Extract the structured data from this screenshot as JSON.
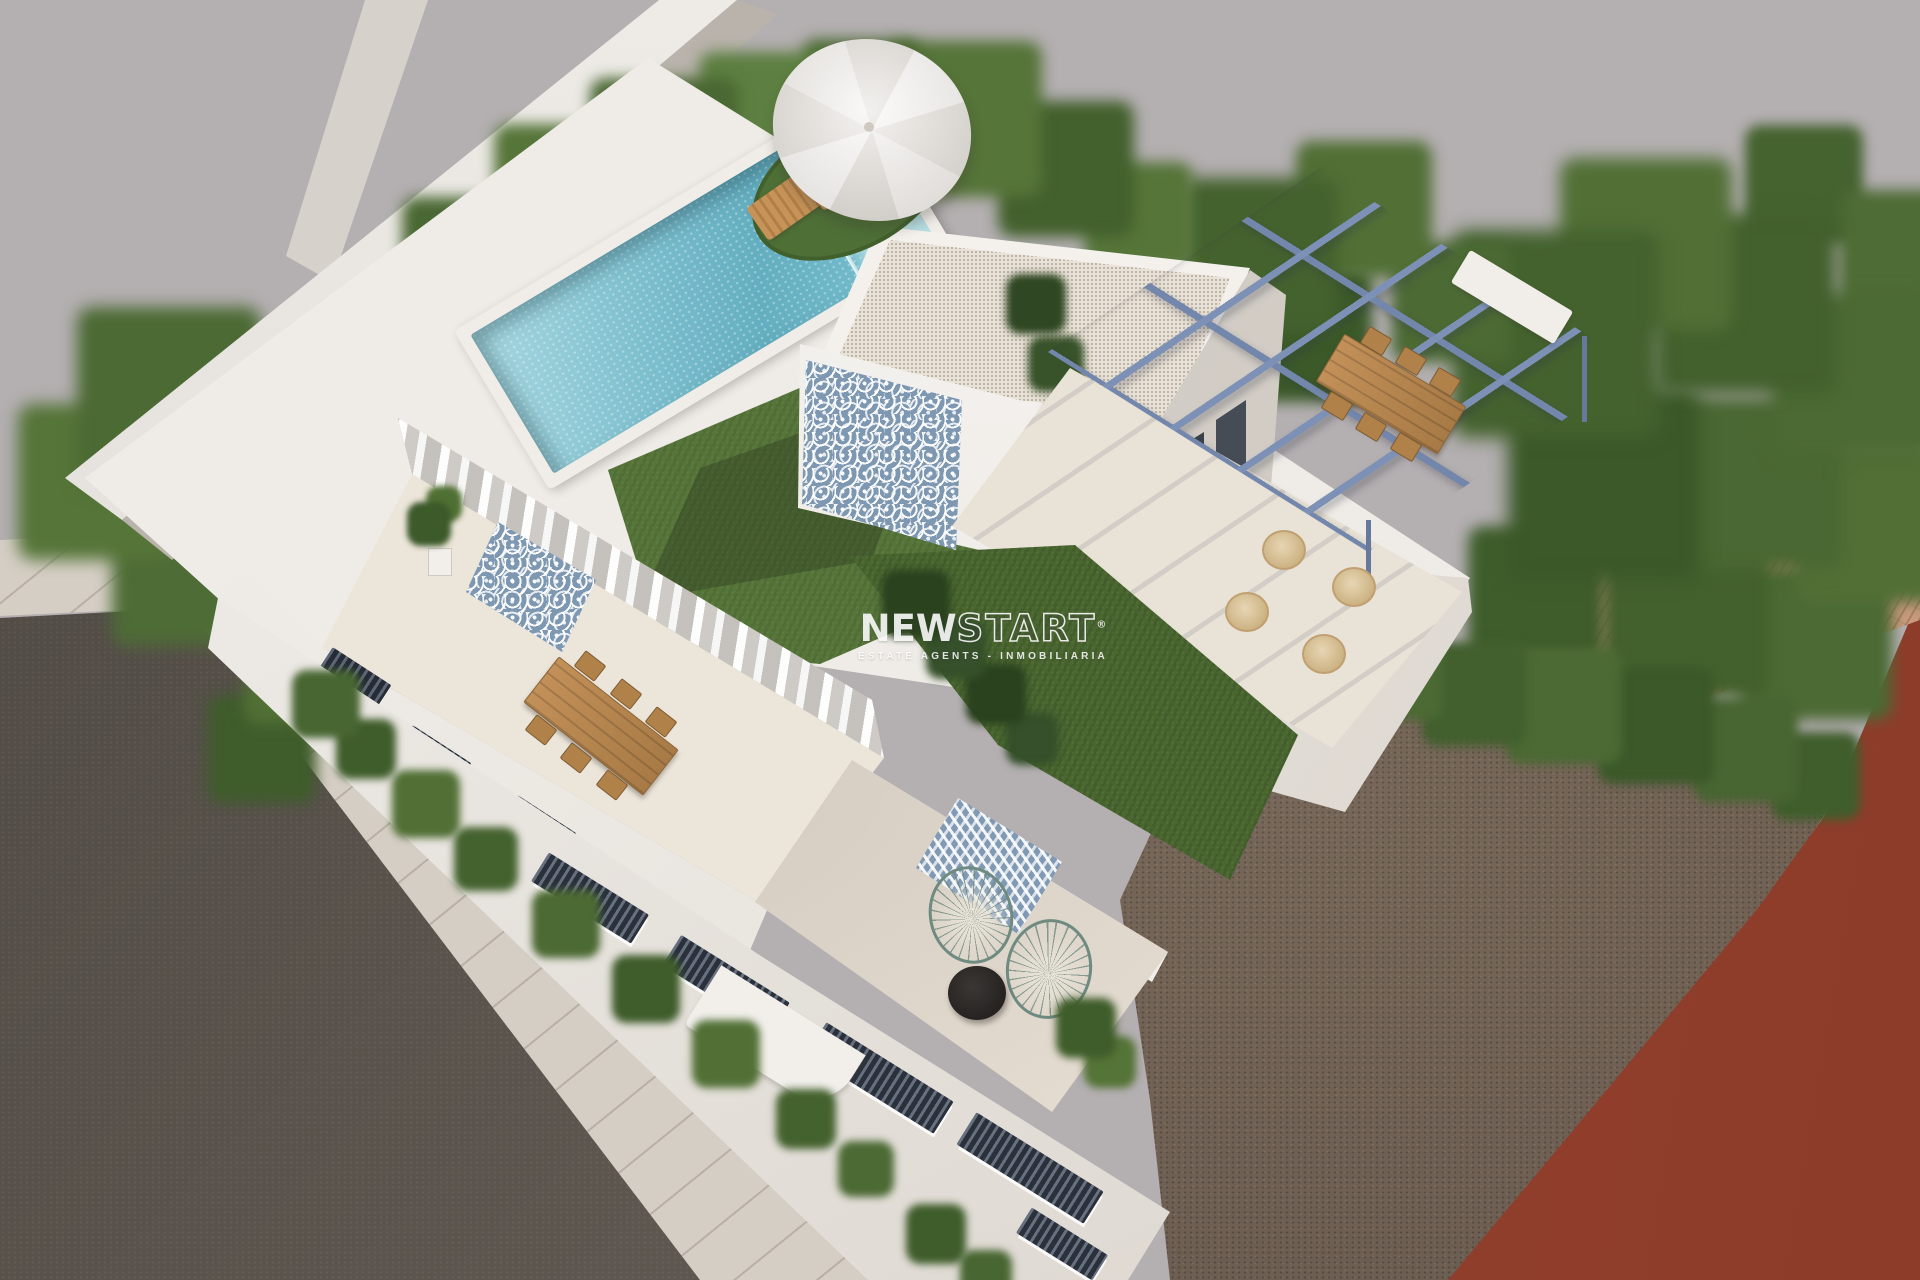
{
  "watermark": {
    "brand_solid": "NEW",
    "brand_outline": "START",
    "registered_symbol": "®",
    "tagline": "ESTATE AGENTS - INMOBILIARIA"
  },
  "scene": {
    "type": "3d-exterior-architectural-render",
    "subject": "Aerial view of a modern two-storey white villa with rooftop pool, lawn, roof room, blue pergola and terraces, surrounded by trees, neighbouring tiled roofs, a red building, a vacant dirt lot, sidewalk and road",
    "elements": [
      "sky",
      "road",
      "sidewalk",
      "dirt-lot",
      "red-building",
      "terracotta-roof-left",
      "terracotta-roof-right",
      "trees",
      "boundary-wall",
      "rooftop-deck",
      "swimming-pool",
      "rooftop-lawn",
      "roof-room",
      "mosaic-tile-wall",
      "blue-pergola",
      "outdoor-dining-set",
      "wicker-chairs",
      "parasol",
      "sun-loungers",
      "first-floor-terrace",
      "glazed-doors-with-curtains",
      "wood-dining-table",
      "ground-terrace",
      "chevron-tile-wall",
      "acapulco-chairs",
      "black-round-table",
      "street-facade",
      "window-slots",
      "planters",
      "potted-plants"
    ]
  },
  "palette": {
    "sky": "#b4afb1",
    "villa_white": "#f3f0ec",
    "floor_cream": "#e9e1d5",
    "pool_water": "#7fc0cf",
    "lawn_green": "#567539",
    "tree_green": "#4c6a34",
    "pergola_blue": "#7c91b5",
    "tile_pattern_blue": "#7f98b2",
    "wood": "#b98a52",
    "terracotta": "#bd8e72",
    "red_building": "#8a3b2a",
    "road_gray": "#5e5750",
    "sidewalk_beige": "#d5cec5",
    "dirt_brown": "#6f5f52"
  }
}
